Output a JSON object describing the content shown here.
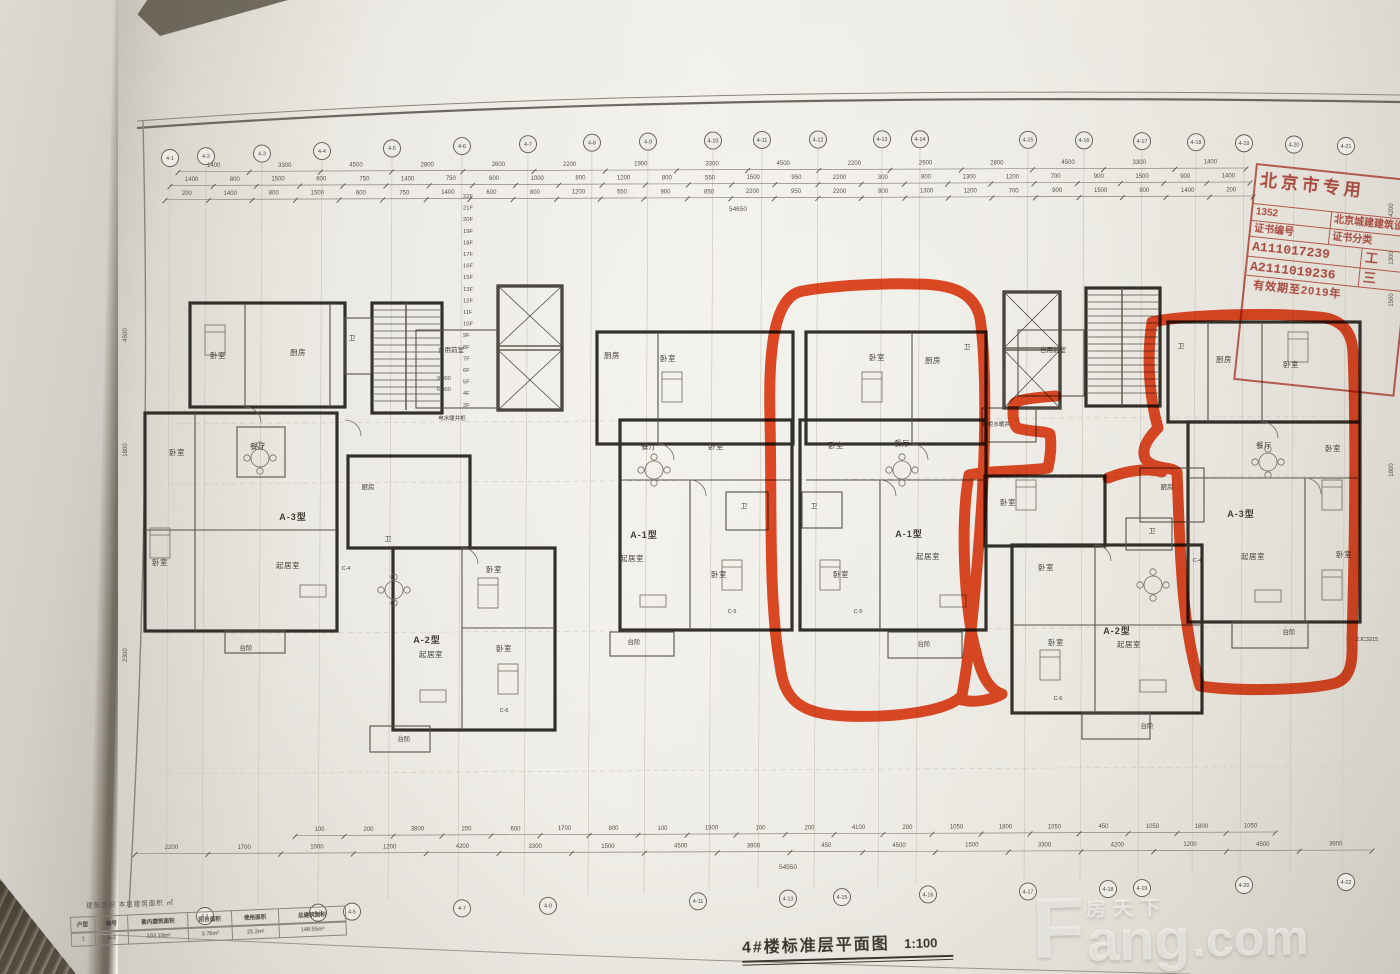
{
  "page": {
    "title": "4#楼标准层平面图",
    "scale": "1:100"
  },
  "watermark": {
    "f": "F",
    "cn": "房天下",
    "ang": "ang",
    "com": ".com"
  },
  "stamp": {
    "header": "北京市专用",
    "rows": [
      {
        "l": "1352",
        "r": "北京城建建筑设"
      },
      {
        "l": "证书编号",
        "r": "证书分类"
      },
      {
        "l": "A111017239",
        "r": "工"
      },
      {
        "l": "A2111019236",
        "r": "三"
      }
    ],
    "footer": "有效期至2019年"
  },
  "area_table": {
    "note": "建筑面积 本层建筑面积 ㎡",
    "headers": [
      "户型",
      "编号",
      "套内建筑面积",
      "阳台面积",
      "使用面积",
      "总建筑面积"
    ],
    "row": [
      "1",
      "A-1",
      "103.19m²",
      "3.76m²",
      "25.2m²",
      "148.55m²"
    ]
  },
  "drawing": {
    "axis_top": [
      "4-1",
      "4-2",
      "4-3",
      "4-4",
      "4-5",
      "4-6",
      "4-7",
      "4-8",
      "4-9",
      "4-10",
      "4-11",
      "4-12",
      "4-13",
      "4-14",
      "4-15",
      "4-16",
      "4-17",
      "4-18",
      "4-19",
      "4-20",
      "4-21"
    ],
    "axis_bottom": [
      "4-1",
      "4-3",
      "4-5",
      "4-7",
      "4-9",
      "4-11",
      "4-13",
      "4-15",
      "4-16",
      "4-17",
      "4-18",
      "4-19",
      "4-20",
      "4-22"
    ],
    "dims_top_row1": [
      "1400",
      "3300",
      "4500",
      "2800",
      "2600",
      "2200",
      "1900",
      "3300",
      "4500",
      "2200",
      "2600",
      "2800",
      "4500",
      "3300",
      "1400"
    ],
    "dims_top_row2": [
      "1400",
      "800",
      "1500",
      "800",
      "750",
      "1400",
      "750",
      "600",
      "1000",
      "800",
      "1200",
      "800",
      "550",
      "1500",
      "950",
      "2200",
      "300",
      "800",
      "1300",
      "1200",
      "700",
      "900",
      "1500",
      "900",
      "1400"
    ],
    "dims_top_row3": [
      "200",
      "1400",
      "800",
      "1500",
      "600",
      "750",
      "1400",
      "600",
      "800",
      "1200",
      "550",
      "900",
      "850",
      "2200",
      "950",
      "2200",
      "800",
      "1300",
      "1200",
      "700",
      "900",
      "1500",
      "900",
      "1400",
      "200"
    ],
    "dims_top_total": "54650",
    "dims_bottom_row1": [
      "100",
      "200",
      "3800",
      "200",
      "600",
      "1700",
      "800",
      "100",
      "1300",
      "100",
      "200",
      "4100",
      "200",
      "1050",
      "1800",
      "1050",
      "450",
      "1050",
      "1800",
      "1050"
    ],
    "dims_bottom_row2": [
      "2200",
      "1700",
      "1000",
      "1200",
      "4200",
      "3300",
      "1500",
      "4500",
      "3900",
      "450",
      "4500",
      "1500",
      "3300",
      "4200",
      "1200",
      "4500",
      "3900"
    ],
    "dims_bottom_total": "54550",
    "dims_left": [
      "4500",
      "1800",
      "2300"
    ],
    "dims_right": [
      "4200",
      "1300",
      "1500",
      "1800"
    ],
    "floors": [
      "22F",
      "21F",
      "20F",
      "19F",
      "18F",
      "17F",
      "16F",
      "15F",
      "13F",
      "12F",
      "11F",
      "10F",
      "9F",
      "8F",
      "7F",
      "6F",
      "5F",
      "4F",
      "3F"
    ],
    "elevations": [
      "9.000",
      "6.000"
    ],
    "rooms": [
      {
        "x": 218,
        "y": 358,
        "t": "卧室"
      },
      {
        "x": 298,
        "y": 355,
        "t": "厨房"
      },
      {
        "x": 352,
        "y": 340,
        "t": "卫",
        "c": "s"
      },
      {
        "x": 451,
        "y": 352,
        "t": "合用前室",
        "c": "s"
      },
      {
        "x": 452,
        "y": 420,
        "t": "电水暖井柜",
        "c": "xs"
      },
      {
        "x": 177,
        "y": 455,
        "t": "卧室"
      },
      {
        "x": 258,
        "y": 449,
        "t": "餐厅"
      },
      {
        "x": 293,
        "y": 520,
        "t": "A-3型",
        "c": "type"
      },
      {
        "x": 160,
        "y": 565,
        "t": "卧室"
      },
      {
        "x": 288,
        "y": 568,
        "t": "起居室"
      },
      {
        "x": 246,
        "y": 650,
        "t": "台阶",
        "c": "s"
      },
      {
        "x": 368,
        "y": 489,
        "t": "厨房",
        "c": "s"
      },
      {
        "x": 388,
        "y": 541,
        "t": "卫",
        "c": "s"
      },
      {
        "x": 346,
        "y": 570,
        "t": "C-4",
        "c": "xs"
      },
      {
        "x": 494,
        "y": 572,
        "t": "卧室"
      },
      {
        "x": 427,
        "y": 643,
        "t": "A-2型",
        "c": "type"
      },
      {
        "x": 431,
        "y": 657,
        "t": "起居室"
      },
      {
        "x": 504,
        "y": 651,
        "t": "卧室"
      },
      {
        "x": 504,
        "y": 712,
        "t": "C-6",
        "c": "xs"
      },
      {
        "x": 404,
        "y": 741,
        "t": "台阶",
        "c": "s"
      },
      {
        "x": 612,
        "y": 358,
        "t": "厨房"
      },
      {
        "x": 668,
        "y": 361,
        "t": "卧室"
      },
      {
        "x": 649,
        "y": 449,
        "t": "餐厅"
      },
      {
        "x": 716,
        "y": 449,
        "t": "卧室"
      },
      {
        "x": 744,
        "y": 508,
        "t": "卫",
        "c": "s"
      },
      {
        "x": 644,
        "y": 538,
        "t": "A-1型",
        "c": "type"
      },
      {
        "x": 632,
        "y": 561,
        "t": "起居室"
      },
      {
        "x": 719,
        "y": 577,
        "t": "卧室"
      },
      {
        "x": 732,
        "y": 613,
        "t": "C-5",
        "c": "xs"
      },
      {
        "x": 634,
        "y": 644,
        "t": "台阶",
        "c": "s"
      },
      {
        "x": 877,
        "y": 360,
        "t": "卧室"
      },
      {
        "x": 933,
        "y": 363,
        "t": "厨房"
      },
      {
        "x": 967,
        "y": 349,
        "t": "卫",
        "c": "s"
      },
      {
        "x": 836,
        "y": 448,
        "t": "卧室"
      },
      {
        "x": 902,
        "y": 446,
        "t": "餐厅"
      },
      {
        "x": 814,
        "y": 508,
        "t": "卫",
        "c": "s"
      },
      {
        "x": 909,
        "y": 537,
        "t": "A-1型",
        "c": "type"
      },
      {
        "x": 928,
        "y": 559,
        "t": "起居室"
      },
      {
        "x": 841,
        "y": 577,
        "t": "卧室"
      },
      {
        "x": 858,
        "y": 613,
        "t": "C-5",
        "c": "xs"
      },
      {
        "x": 996,
        "y": 426,
        "t": "鞋柜水暖井",
        "c": "xs"
      },
      {
        "x": 924,
        "y": 646,
        "t": "台阶",
        "c": "s"
      },
      {
        "x": 1053,
        "y": 352,
        "t": "合用前室",
        "c": "s"
      },
      {
        "x": 1008,
        "y": 505,
        "t": "卧室"
      },
      {
        "x": 1167,
        "y": 489,
        "t": "厨房",
        "c": "s"
      },
      {
        "x": 1152,
        "y": 533,
        "t": "卫",
        "c": "s"
      },
      {
        "x": 1046,
        "y": 570,
        "t": "卧室"
      },
      {
        "x": 1117,
        "y": 634,
        "t": "A-2型",
        "c": "type"
      },
      {
        "x": 1129,
        "y": 647,
        "t": "起居室"
      },
      {
        "x": 1056,
        "y": 645,
        "t": "卧室"
      },
      {
        "x": 1058,
        "y": 700,
        "t": "C-6",
        "c": "xs"
      },
      {
        "x": 1197,
        "y": 562,
        "t": "C-4",
        "c": "xs"
      },
      {
        "x": 1147,
        "y": 728,
        "t": "台阶",
        "c": "s"
      },
      {
        "x": 1181,
        "y": 348,
        "t": "卫",
        "c": "s"
      },
      {
        "x": 1224,
        "y": 362,
        "t": "厨房"
      },
      {
        "x": 1291,
        "y": 367,
        "t": "卧室"
      },
      {
        "x": 1264,
        "y": 448,
        "t": "餐厅"
      },
      {
        "x": 1333,
        "y": 451,
        "t": "卧室"
      },
      {
        "x": 1241,
        "y": 517,
        "t": "A-3型",
        "c": "type"
      },
      {
        "x": 1253,
        "y": 559,
        "t": "起居室"
      },
      {
        "x": 1344,
        "y": 557,
        "t": "卧室"
      },
      {
        "x": 1289,
        "y": 634,
        "t": "台阶",
        "c": "s"
      },
      {
        "x": 1367,
        "y": 641,
        "t": "ZJC3215",
        "c": "xs"
      }
    ]
  },
  "annotations": {
    "strokes": [
      "M803,291 C775,295 768,345 770,420 C772,500 768,600 780,665 C784,700 800,714 845,716 C890,718 950,712 962,695 C972,640 978,560 982,500 C986,430 986,360 980,318 C974,292 952,284 915,284 C878,283 830,286 803,291 Z",
      "M1056,396 C1030,398 1016,400 1014,404 C1012,412 1013,424 1017,428 C1030,432 1046,431 1050,434 C1052,446 1050,458 1048,468 C1020,472 990,470 969,475 C960,520 964,610 976,652 C982,678 990,690 1002,694 C992,700 975,703 962,700",
      "M1152,322 C1146,360 1150,400 1158,428 C1148,438 1140,450 1146,460 C1156,470 1170,466 1177,472 C1180,540 1180,620 1200,686 C1240,692 1310,690 1336,683 C1350,678 1353,664 1352,640 C1355,540 1356,420 1353,352 C1352,334 1344,322 1326,318 C1280,312 1190,314 1152,322 Z",
      "M1108,478 C1128,470 1148,468 1162,472"
    ]
  },
  "colors": {
    "marker": "#e5380e",
    "stamp_red": "#b03629",
    "ink": "#45423c",
    "wall": "#32302b",
    "paper": "#efede7"
  }
}
